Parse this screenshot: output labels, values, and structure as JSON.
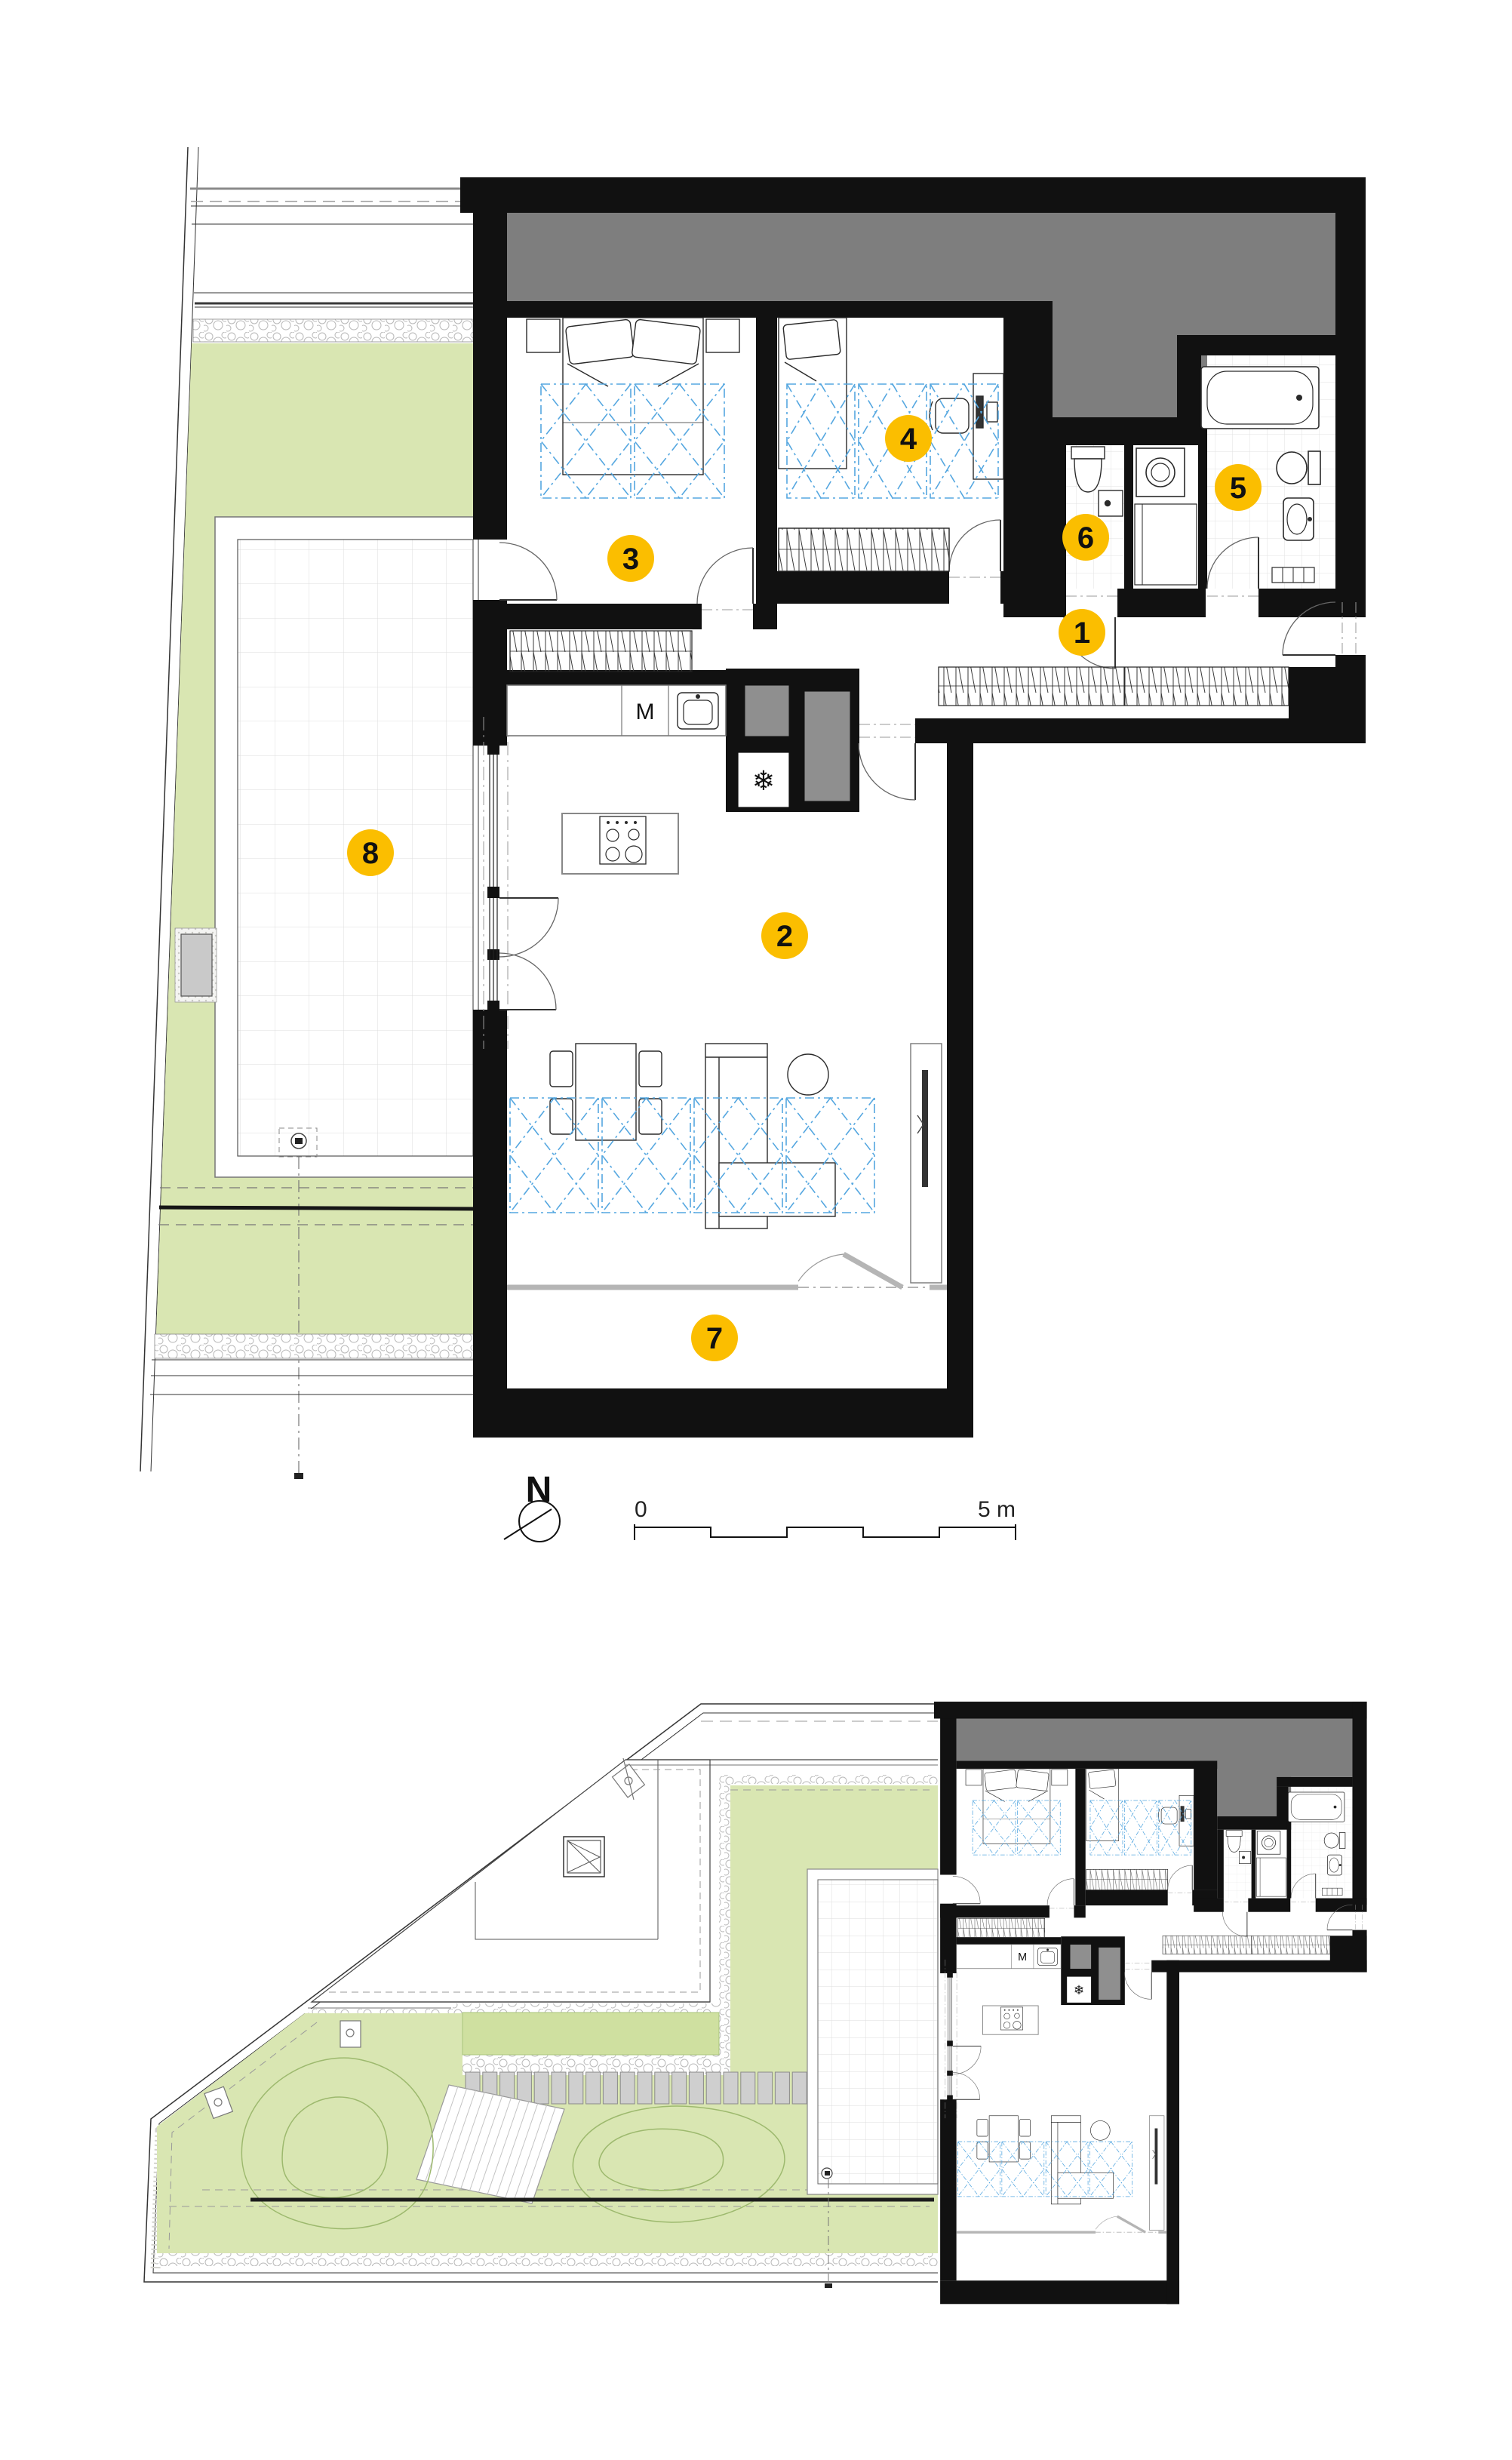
{
  "document": {
    "type": "architectural floor plan",
    "sheet_background": "#ffffff"
  },
  "labels": {
    "north": "N",
    "scale_start": "0",
    "scale_end": "5 m",
    "kitchen_appliance": "M",
    "freezer_symbol": "❄"
  },
  "rooms": [
    {
      "number": "1"
    },
    {
      "number": "2"
    },
    {
      "number": "3"
    },
    {
      "number": "4"
    },
    {
      "number": "5"
    },
    {
      "number": "6"
    },
    {
      "number": "7"
    },
    {
      "number": "8"
    }
  ],
  "colors": {
    "wall_black": "#111111",
    "roof_gray": "#7e7e7e",
    "shaft_gray": "#8f8f8f",
    "marker_yellow": "#FBBE00",
    "garden_green": "#d9e6b2",
    "planter_green": "#cfe0a0",
    "contour_green": "#9db96e",
    "furniture_zone_blue": "#55a7e0",
    "paver_gray": "#cfcfcf",
    "loggia_gray": "#b5b5b5"
  }
}
